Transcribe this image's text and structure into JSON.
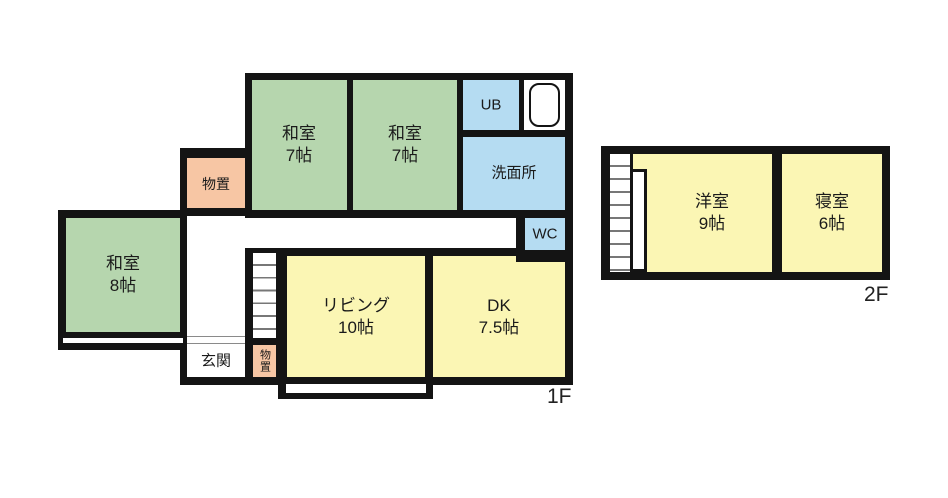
{
  "floors": {
    "f1": {
      "label": "1F",
      "rooms": {
        "washitsu7a": {
          "name": "和室",
          "size": "7帖"
        },
        "washitsu7b": {
          "name": "和室",
          "size": "7帖"
        },
        "ub": {
          "name": "UB"
        },
        "senmenjo": {
          "name": "洗面所"
        },
        "wc": {
          "name": "WC"
        },
        "washitsu8": {
          "name": "和室",
          "size": "8帖"
        },
        "monooki_left": {
          "name": "物置"
        },
        "living": {
          "name": "リビング",
          "size": "10帖"
        },
        "dk": {
          "name": "DK",
          "size": "7.5帖"
        },
        "genkan": {
          "name": "玄関"
        },
        "monooki_small": {
          "name": "物置"
        }
      }
    },
    "f2": {
      "label": "2F",
      "rooms": {
        "yoshitsu": {
          "name": "洋室",
          "size": "9帖"
        },
        "shinshitsu": {
          "name": "寝室",
          "size": "6帖"
        }
      }
    }
  },
  "colors": {
    "tatami_green": "#b6d6ae",
    "room_yellow": "#fbf6b4",
    "storage_salmon": "#f7c6a4",
    "water_blue": "#b5dcf2",
    "wall_black": "#141414",
    "stair_tread_gray": "#777777"
  }
}
